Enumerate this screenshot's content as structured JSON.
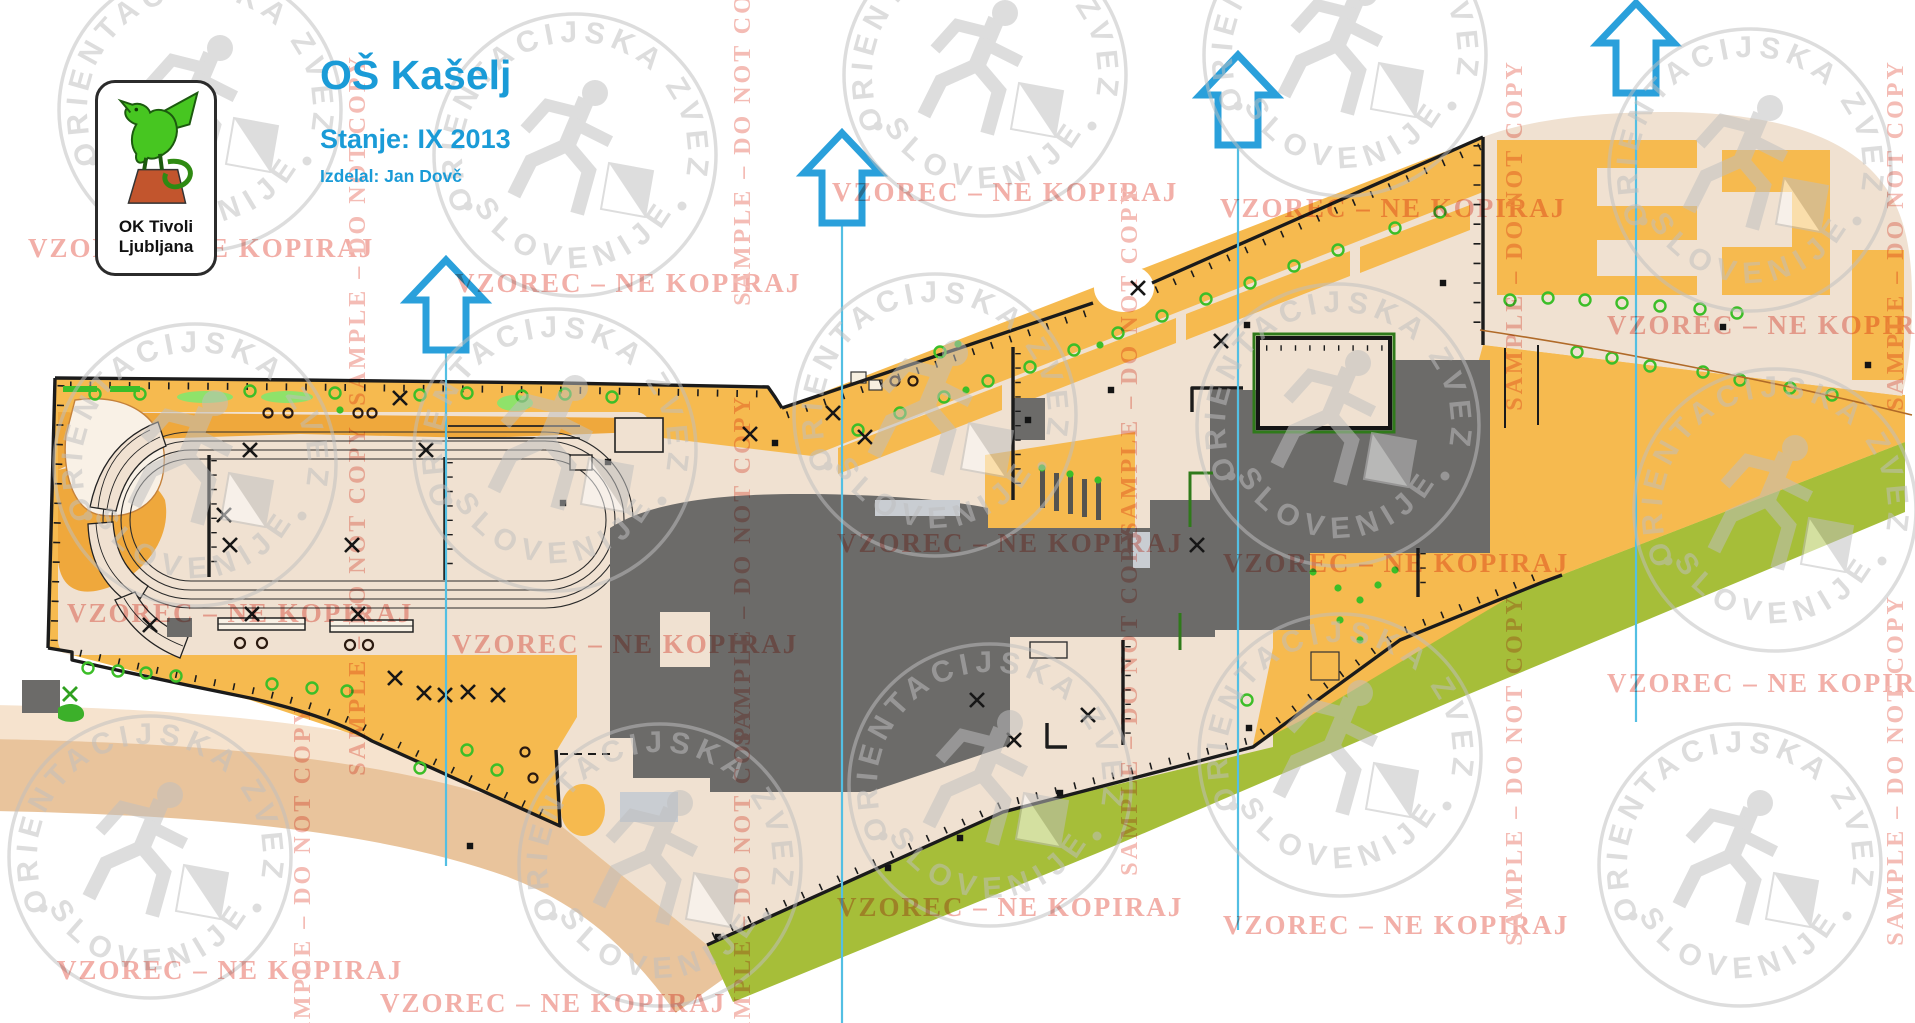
{
  "header": {
    "title": "OŠ Kašelj",
    "status": "Stanje: IX 2013",
    "credit": "Izdelal: Jan Dovč",
    "logo_club_line1": "OK Tivoli",
    "logo_club_line2": "Ljubljana"
  },
  "watermarks": {
    "stamp_arc_top": "ORIENTACIJSKA ZVEZA",
    "stamp_arc_bottom": "SLOVENIJE",
    "sample_text": "SAMPLE – DO NOT COPY",
    "vzorec_text": "VZOREC – NE KOPIRAJ"
  },
  "map_colors": {
    "open_land": "#F6BA4F",
    "rough_open": "#EFA83C",
    "paved_area": "#F0E1D1",
    "building": "#6C6B69",
    "canopy": "#C9CDD2",
    "vegetation_strip": "#A6BE39",
    "tree_green": "#3CBE28",
    "road": "#E9C49C",
    "north_arrow_blue": "#2AA0DB",
    "meridian_blue": "#53BFE3",
    "title_blue": "#1A9BD7",
    "watermark_red": "#F2AFA8",
    "watermark_gray": "#BFBFBF"
  }
}
